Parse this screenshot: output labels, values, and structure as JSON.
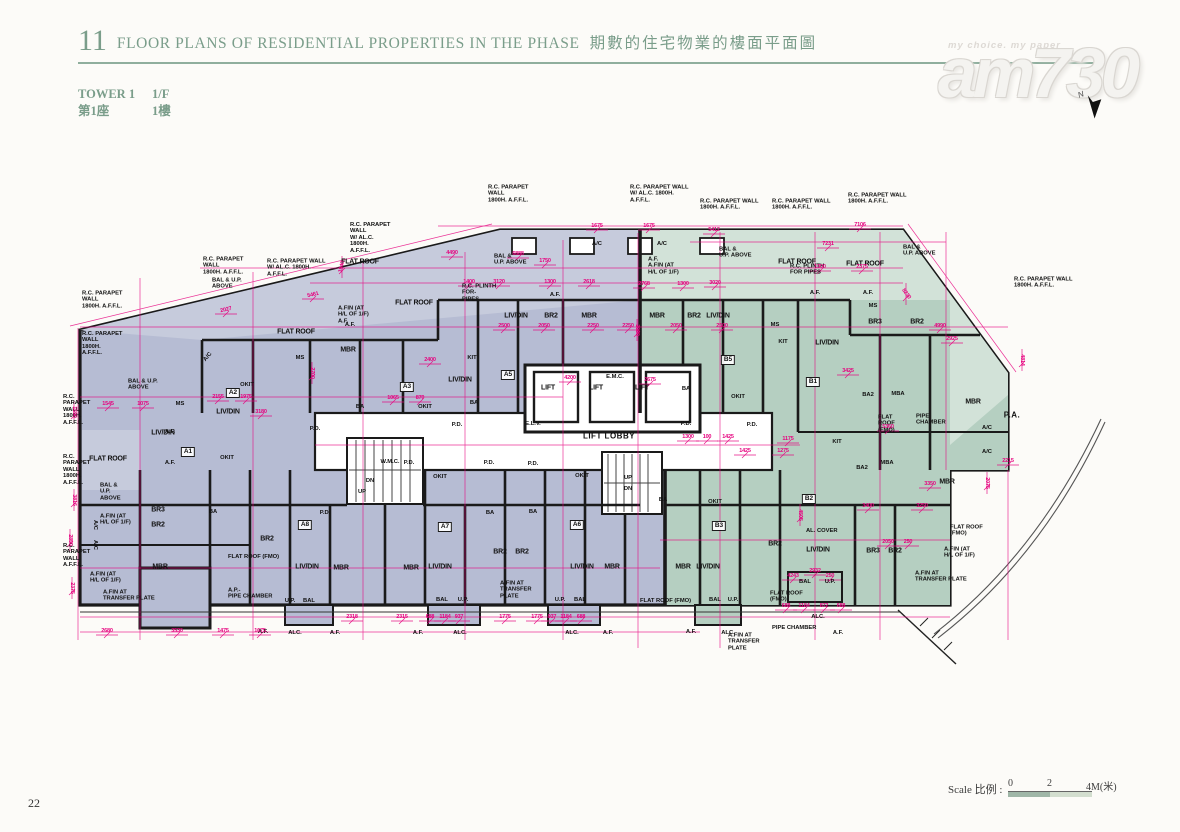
{
  "header": {
    "section_no": "11",
    "title_en": "FLOOR PLANS OF RESIDENTIAL PROPERTIES IN THE PHASE",
    "title_zh": "期數的住宅物業的樓面平面圖",
    "tower_en": "TOWER 1",
    "floor_en": "1/F",
    "tower_zh": "第1座",
    "floor_zh": "1樓"
  },
  "watermark": {
    "tagline": "my choice.  my paper",
    "logo": "am730",
    "north_label": "N"
  },
  "footer": {
    "page_no": "22"
  },
  "scale": {
    "label_en": "Scale",
    "label_zh": "比例",
    "colon": " : ",
    "ticks": [
      "0",
      "2",
      "4M(米)"
    ]
  },
  "colors": {
    "header_green": "#7a9d8a",
    "rule_green": "#8fae9d",
    "unit_a_fill": "#b6bcd3",
    "unit_a_light": "#c6cbdc",
    "unit_b_fill": "#b5cfc1",
    "unit_b_light": "#d2e2d8",
    "dimension_magenta": "#e6007e",
    "wall_black": "#1a1a1a"
  },
  "plan": {
    "unit_badges": [
      [
        "A1",
        188,
        452
      ],
      [
        "A2",
        233,
        393
      ],
      [
        "A3",
        407,
        387
      ],
      [
        "A5",
        508,
        375
      ],
      [
        "A6",
        577,
        525
      ],
      [
        "A7",
        445,
        527
      ],
      [
        "A8",
        305,
        525
      ],
      [
        "B1",
        813,
        382
      ],
      [
        "B2",
        809,
        499
      ],
      [
        "B3",
        719,
        526
      ],
      [
        "B5",
        728,
        360
      ]
    ],
    "room_labels": [
      [
        "LIV/DIN",
        163,
        433
      ],
      [
        "LIV/DIN",
        228,
        412
      ],
      [
        "LIV/DIN",
        460,
        380
      ],
      [
        "LIV/DIN",
        516,
        316
      ],
      [
        "LIV/DIN",
        718,
        316
      ],
      [
        "LIV/DIN",
        827,
        343
      ],
      [
        "LIV/DIN",
        307,
        567
      ],
      [
        "LIV/DIN",
        440,
        567
      ],
      [
        "LIV/DIN",
        582,
        567
      ],
      [
        "LIV/DIN",
        708,
        567
      ],
      [
        "LIV/DIN",
        818,
        550
      ],
      [
        "MBR",
        348,
        350
      ],
      [
        "MBR",
        589,
        316
      ],
      [
        "MBR",
        657,
        316
      ],
      [
        "MBR",
        973,
        402
      ],
      [
        "MBR",
        947,
        482
      ],
      [
        "MBR",
        160,
        567
      ],
      [
        "MBR",
        341,
        568
      ],
      [
        "MBR",
        411,
        568
      ],
      [
        "MBR",
        612,
        567
      ],
      [
        "MBR",
        683,
        567
      ],
      [
        "BR2",
        551,
        316
      ],
      [
        "BR2",
        694,
        316
      ],
      [
        "BR2",
        917,
        322
      ],
      [
        "BR2",
        158,
        525
      ],
      [
        "BR2",
        267,
        539
      ],
      [
        "BR2",
        500,
        552
      ],
      [
        "BR2",
        522,
        552
      ],
      [
        "BR2",
        775,
        544
      ],
      [
        "BR2",
        895,
        551
      ],
      [
        "BR3",
        875,
        322
      ],
      [
        "BR3",
        158,
        510
      ],
      [
        "BR3",
        873,
        551
      ],
      [
        "FLAT ROOF",
        108,
        459
      ],
      [
        "FLAT ROOF",
        296,
        332
      ],
      [
        "FLAT ROOF",
        414,
        303
      ],
      [
        "FLAT ROOF",
        360,
        262
      ],
      [
        "FLAT ROOF",
        797,
        262
      ],
      [
        "FLAT ROOF",
        865,
        264
      ],
      [
        "LIFT",
        548,
        388
      ],
      [
        "LIFT",
        596,
        388
      ],
      [
        "LIFT",
        642,
        388
      ]
    ],
    "big_labels": [
      [
        "LIFT LOBBY",
        609,
        436
      ],
      [
        "P.A.",
        1012,
        415
      ]
    ],
    "small_labels": [
      [
        "BAL",
        309,
        601
      ],
      [
        "BAL",
        442,
        600
      ],
      [
        "BAL",
        580,
        600
      ],
      [
        "BAL",
        715,
        600
      ],
      [
        "BAL",
        805,
        582
      ],
      [
        "U.P.",
        290,
        601
      ],
      [
        "U.P.",
        463,
        600
      ],
      [
        "U.P.",
        560,
        600
      ],
      [
        "U.P.",
        733,
        600
      ],
      [
        "U.P.",
        830,
        582
      ],
      [
        "BA",
        360,
        407
      ],
      [
        "BA",
        474,
        403
      ],
      [
        "BA",
        686,
        389
      ],
      [
        "BA",
        213,
        512
      ],
      [
        "BA",
        490,
        513
      ],
      [
        "BA",
        533,
        512
      ],
      [
        "BA",
        663,
        500
      ],
      [
        "BA2",
        868,
        395
      ],
      [
        "BA2",
        862,
        468
      ],
      [
        "MBA",
        898,
        394
      ],
      [
        "MBA",
        887,
        463
      ],
      [
        "KIT",
        783,
        342
      ],
      [
        "KIT",
        837,
        442
      ],
      [
        "KIT",
        472,
        358
      ],
      [
        "OKIT",
        247,
        385
      ],
      [
        "OKIT",
        425,
        407
      ],
      [
        "OKIT",
        227,
        458
      ],
      [
        "OKIT",
        440,
        477
      ],
      [
        "OKIT",
        582,
        476
      ],
      [
        "OKIT",
        715,
        502
      ],
      [
        "OKIT",
        738,
        397
      ],
      [
        "P.D.",
        409,
        463
      ],
      [
        "P.D.",
        489,
        463
      ],
      [
        "P.D.",
        533,
        464
      ],
      [
        "P.D.",
        686,
        424
      ],
      [
        "P.D.",
        752,
        425
      ],
      [
        "P.D.",
        315,
        429
      ],
      [
        "P.D.",
        457,
        425
      ],
      [
        "P.D.",
        325,
        513
      ],
      [
        "MS",
        180,
        404
      ],
      [
        "MS",
        300,
        358
      ],
      [
        "MS",
        775,
        325
      ],
      [
        "MS",
        873,
        306
      ],
      [
        "E.L.V.",
        533,
        424
      ],
      [
        "W.M.C.",
        390,
        462
      ],
      [
        "E.M.C.",
        615,
        377
      ],
      [
        "A/C",
        597,
        244
      ],
      [
        "A/C",
        662,
        244
      ],
      [
        "A/C",
        987,
        428
      ],
      [
        "A/C",
        987,
        452
      ],
      [
        "A/C",
        208,
        357,
        -50
      ],
      [
        "A/C",
        95,
        525,
        90
      ],
      [
        "A/C",
        95,
        545,
        90
      ],
      [
        "A.F.",
        170,
        432
      ],
      [
        "A.F.",
        170,
        463
      ],
      [
        "A.F.",
        350,
        325
      ],
      [
        "A.F.",
        263,
        632
      ],
      [
        "A.F.",
        335,
        633
      ],
      [
        "A.F.",
        418,
        633
      ],
      [
        "A.F.",
        608,
        633
      ],
      [
        "A.F.",
        691,
        632
      ],
      [
        "A.F.",
        838,
        633
      ],
      [
        "A.F.",
        815,
        293
      ],
      [
        "A.F.",
        868,
        293
      ],
      [
        "A.F.",
        555,
        295
      ],
      [
        "ALC.",
        295,
        633
      ],
      [
        "ALC.",
        460,
        633
      ],
      [
        "ALC.",
        572,
        633
      ],
      [
        "ALC.",
        728,
        633
      ],
      [
        "ALC.",
        818,
        617
      ],
      [
        "DN",
        370,
        481
      ],
      [
        "UP",
        362,
        492
      ],
      [
        "UP",
        628,
        478
      ],
      [
        "DN",
        628,
        489
      ]
    ],
    "annotations": [
      [
        "R.C. PARAPET\nWALL\n1800H. A.F.F.L.",
        82,
        300
      ],
      [
        "R.C. PARAPET\nWALL\n1800H.\nA.F.F.L.",
        82,
        344
      ],
      [
        "R.C.\nPARAPET\nWALL\n1800H.\nA.F.F.L.",
        63,
        410
      ],
      [
        "R.C.\nPARAPET\nWALL\n1800H.\nA.F.F.L.",
        63,
        470
      ],
      [
        "R.C.\nPARAPET\nWALL\nA.F.F.L.",
        63,
        556
      ],
      [
        "R.C. PARAPET\nWALL\n1800H. A.F.F.L.",
        203,
        266
      ],
      [
        "R.C. PARAPET WALL\nW/ AL.C. 1800H.\nA.F.F.L.",
        267,
        268
      ],
      [
        "R.C. PARAPET\nWALL\nW/ AL.C.\n1800H.\nA.F.F.L.",
        350,
        238
      ],
      [
        "R.C. PARAPET\nWALL\n1800H. A.F.F.L.",
        488,
        194
      ],
      [
        "R.C. PARAPET WALL\nW/ AL.C. 1800H.\nA.F.F.L.",
        630,
        194
      ],
      [
        "R.C. PARAPET WALL\n1800H. A.F.F.L.",
        700,
        205
      ],
      [
        "R.C. PARAPET WALL\n1800H. A.F.F.L.",
        772,
        205
      ],
      [
        "R.C. PARAPET WALL\n1800H. A.F.F.L.",
        848,
        199
      ],
      [
        "R.C. PARAPET WALL\n1800H. A.F.F.L.",
        1014,
        283
      ],
      [
        "BAL & U.P.\nABOVE",
        212,
        284
      ],
      [
        "BAL &\nU.P. ABOVE",
        494,
        260
      ],
      [
        "BAL &\nU.P. ABOVE",
        719,
        253
      ],
      [
        "BAL &\nU.P. ABOVE",
        903,
        251
      ],
      [
        "R.C. PLINTH\nFOR-\nPIPES",
        462,
        293
      ],
      [
        "R.C. PLINTH\nFOR PIPES",
        790,
        270
      ],
      [
        "A.FIN (AT\nH/L OF 1/F)\nA.F.",
        338,
        315
      ],
      [
        "A.F.\nA.FIN (AT\nH/L OF 1/F)",
        648,
        266
      ],
      [
        "BAL & U.P.\nABOVE",
        128,
        385
      ],
      [
        "BAL &\nU.P.\nABOVE",
        100,
        492
      ],
      [
        "A.FIN (AT\nH/L OF 1/F)",
        100,
        520
      ],
      [
        "A.FIN (AT\nH/L OF 1/F)",
        90,
        578
      ],
      [
        "A.FIN AT\nTRANSFER PLATE",
        103,
        596
      ],
      [
        "A.FIN AT\nTRANSFER\nPLATE",
        500,
        590
      ],
      [
        "A.FIN AT\nTRANSFER\nPLATE",
        728,
        642
      ],
      [
        "A.FIN AT\nTRANSFER PLATE",
        915,
        577
      ],
      [
        "A.FIN (AT\nH/L OF 1/F)",
        944,
        553
      ],
      [
        "FLAT ROOF\n(FMO)",
        950,
        531
      ],
      [
        "A.P.-\nPIPE CHAMBER",
        228,
        594
      ],
      [
        "PIPE\nCHAMBER",
        916,
        420
      ],
      [
        "FLAT\nROOF\n(FMO)",
        878,
        424
      ],
      [
        "FLAT ROOF (FMO)",
        640,
        601
      ],
      [
        "FLAT ROOF\n(FMO)",
        770,
        597
      ],
      [
        "FLAT ROOF (FMO)",
        228,
        557
      ],
      [
        "AL. COVER",
        806,
        531
      ],
      [
        "PIPE CHAMBER",
        772,
        628
      ]
    ],
    "dimensions": [
      [
        "4490",
        452,
        253
      ],
      [
        "1675",
        597,
        226
      ],
      [
        "1675",
        649,
        226
      ],
      [
        "5412",
        714,
        230
      ],
      [
        "7106",
        860,
        225
      ],
      [
        "7231",
        828,
        244
      ],
      [
        "6888",
        518,
        254
      ],
      [
        "1750",
        545,
        261
      ],
      [
        "5461",
        313,
        295,
        -13
      ],
      [
        "2027",
        226,
        310,
        -13
      ],
      [
        "1940",
        342,
        267,
        -76
      ],
      [
        "1400",
        469,
        282
      ],
      [
        "3120",
        499,
        282
      ],
      [
        "1300",
        550,
        282
      ],
      [
        "2618",
        589,
        282
      ],
      [
        "2768",
        644,
        284
      ],
      [
        "1300",
        683,
        284
      ],
      [
        "3020",
        715,
        283
      ],
      [
        "1300",
        820,
        267
      ],
      [
        "2375",
        862,
        267
      ],
      [
        "8230",
        906,
        294,
        54
      ],
      [
        "2500",
        504,
        326
      ],
      [
        "2050",
        544,
        326
      ],
      [
        "2250",
        593,
        326
      ],
      [
        "2250",
        628,
        326
      ],
      [
        "2050",
        676,
        326
      ],
      [
        "2500",
        722,
        326
      ],
      [
        "4990",
        940,
        326
      ],
      [
        "4814",
        1022,
        360,
        90
      ],
      [
        "2215",
        1008,
        461
      ],
      [
        "2155",
        218,
        397
      ],
      [
        "1975",
        246,
        397
      ],
      [
        "3180",
        261,
        412
      ],
      [
        "1545",
        108,
        404
      ],
      [
        "1075",
        143,
        404
      ],
      [
        "2700",
        312,
        373,
        90
      ],
      [
        "2400",
        430,
        360
      ],
      [
        "1065",
        393,
        398
      ],
      [
        "870",
        420,
        398
      ],
      [
        "4200",
        570,
        378
      ],
      [
        "2675",
        650,
        380
      ],
      [
        "1300",
        688,
        437
      ],
      [
        "100",
        707,
        437
      ],
      [
        "1425",
        728,
        437
      ],
      [
        "1175",
        788,
        439
      ],
      [
        "1425",
        745,
        451
      ],
      [
        "1275",
        783,
        451
      ],
      [
        "3425",
        848,
        371
      ],
      [
        "5360",
        888,
        427
      ],
      [
        "2925",
        952,
        339
      ],
      [
        "3400",
        868,
        506
      ],
      [
        "3250",
        922,
        506
      ],
      [
        "3350",
        930,
        484
      ],
      [
        "2050",
        888,
        542
      ],
      [
        "250",
        908,
        542
      ],
      [
        "2932",
        815,
        571
      ],
      [
        "4243",
        793,
        576
      ],
      [
        "250",
        830,
        576
      ],
      [
        "2680",
        107,
        631
      ],
      [
        "3530",
        177,
        631
      ],
      [
        "1475",
        223,
        631
      ],
      [
        "1675",
        260,
        631
      ],
      [
        "2318",
        352,
        617
      ],
      [
        "2315",
        402,
        617
      ],
      [
        "688",
        430,
        617
      ],
      [
        "1184",
        445,
        617
      ],
      [
        "937",
        459,
        617
      ],
      [
        "1775",
        505,
        617
      ],
      [
        "1775",
        537,
        617
      ],
      [
        "937",
        552,
        617
      ],
      [
        "1184",
        566,
        617
      ],
      [
        "688",
        581,
        617
      ],
      [
        "688",
        786,
        606
      ],
      [
        "1184",
        804,
        606
      ],
      [
        "872",
        824,
        606
      ],
      [
        "688",
        841,
        606
      ],
      [
        "1590",
        74,
        412,
        90
      ],
      [
        "3816",
        74,
        500,
        90
      ],
      [
        "2850",
        70,
        540,
        90
      ],
      [
        "2375",
        72,
        588,
        90
      ],
      [
        "3080",
        637,
        330,
        90
      ],
      [
        "4505",
        800,
        515,
        90
      ],
      [
        "2075",
        987,
        483,
        90
      ]
    ]
  }
}
